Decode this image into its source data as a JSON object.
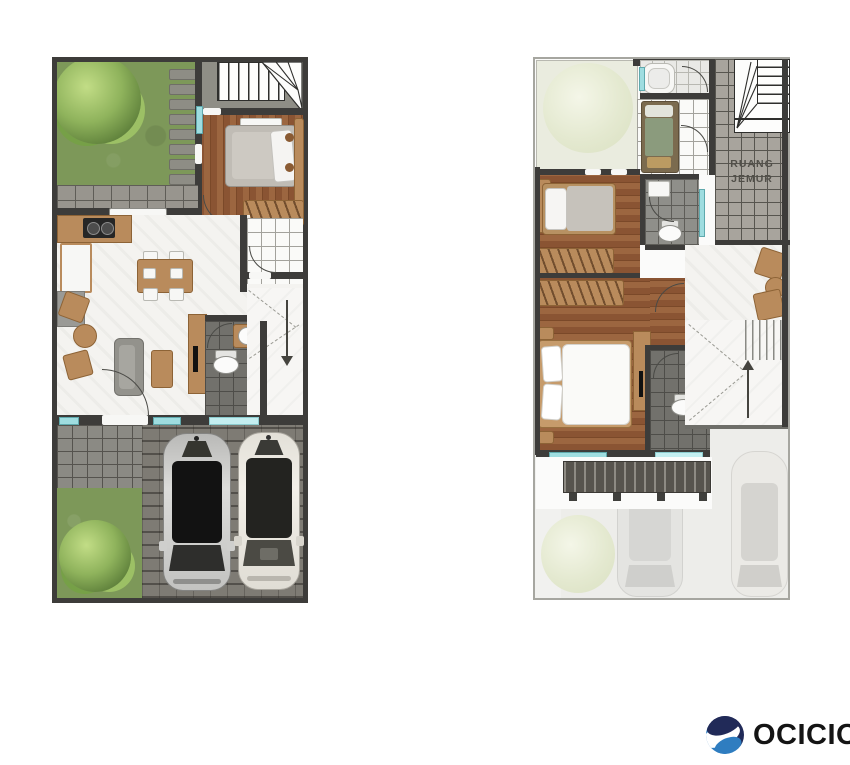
{
  "labels": {
    "ruang_jemur_line1": "RUANG",
    "ruang_jemur_line2": "JEMUR"
  },
  "brand": {
    "name": "OCICIO",
    "logo_navy": "#212a58",
    "logo_blue": "#2f7dc0",
    "text_color": "#141414"
  },
  "palette": {
    "wall": "#3d3c3a",
    "grass": "#7d9859",
    "wood_floor": "#8f5936",
    "marble": "#f4f3f0",
    "pavement": "#98958e",
    "dark_tile": "#72716c",
    "laundry_tile": "#a8a49d",
    "window_glass": "#9fdde0",
    "ghost_floor": "#ededea"
  }
}
